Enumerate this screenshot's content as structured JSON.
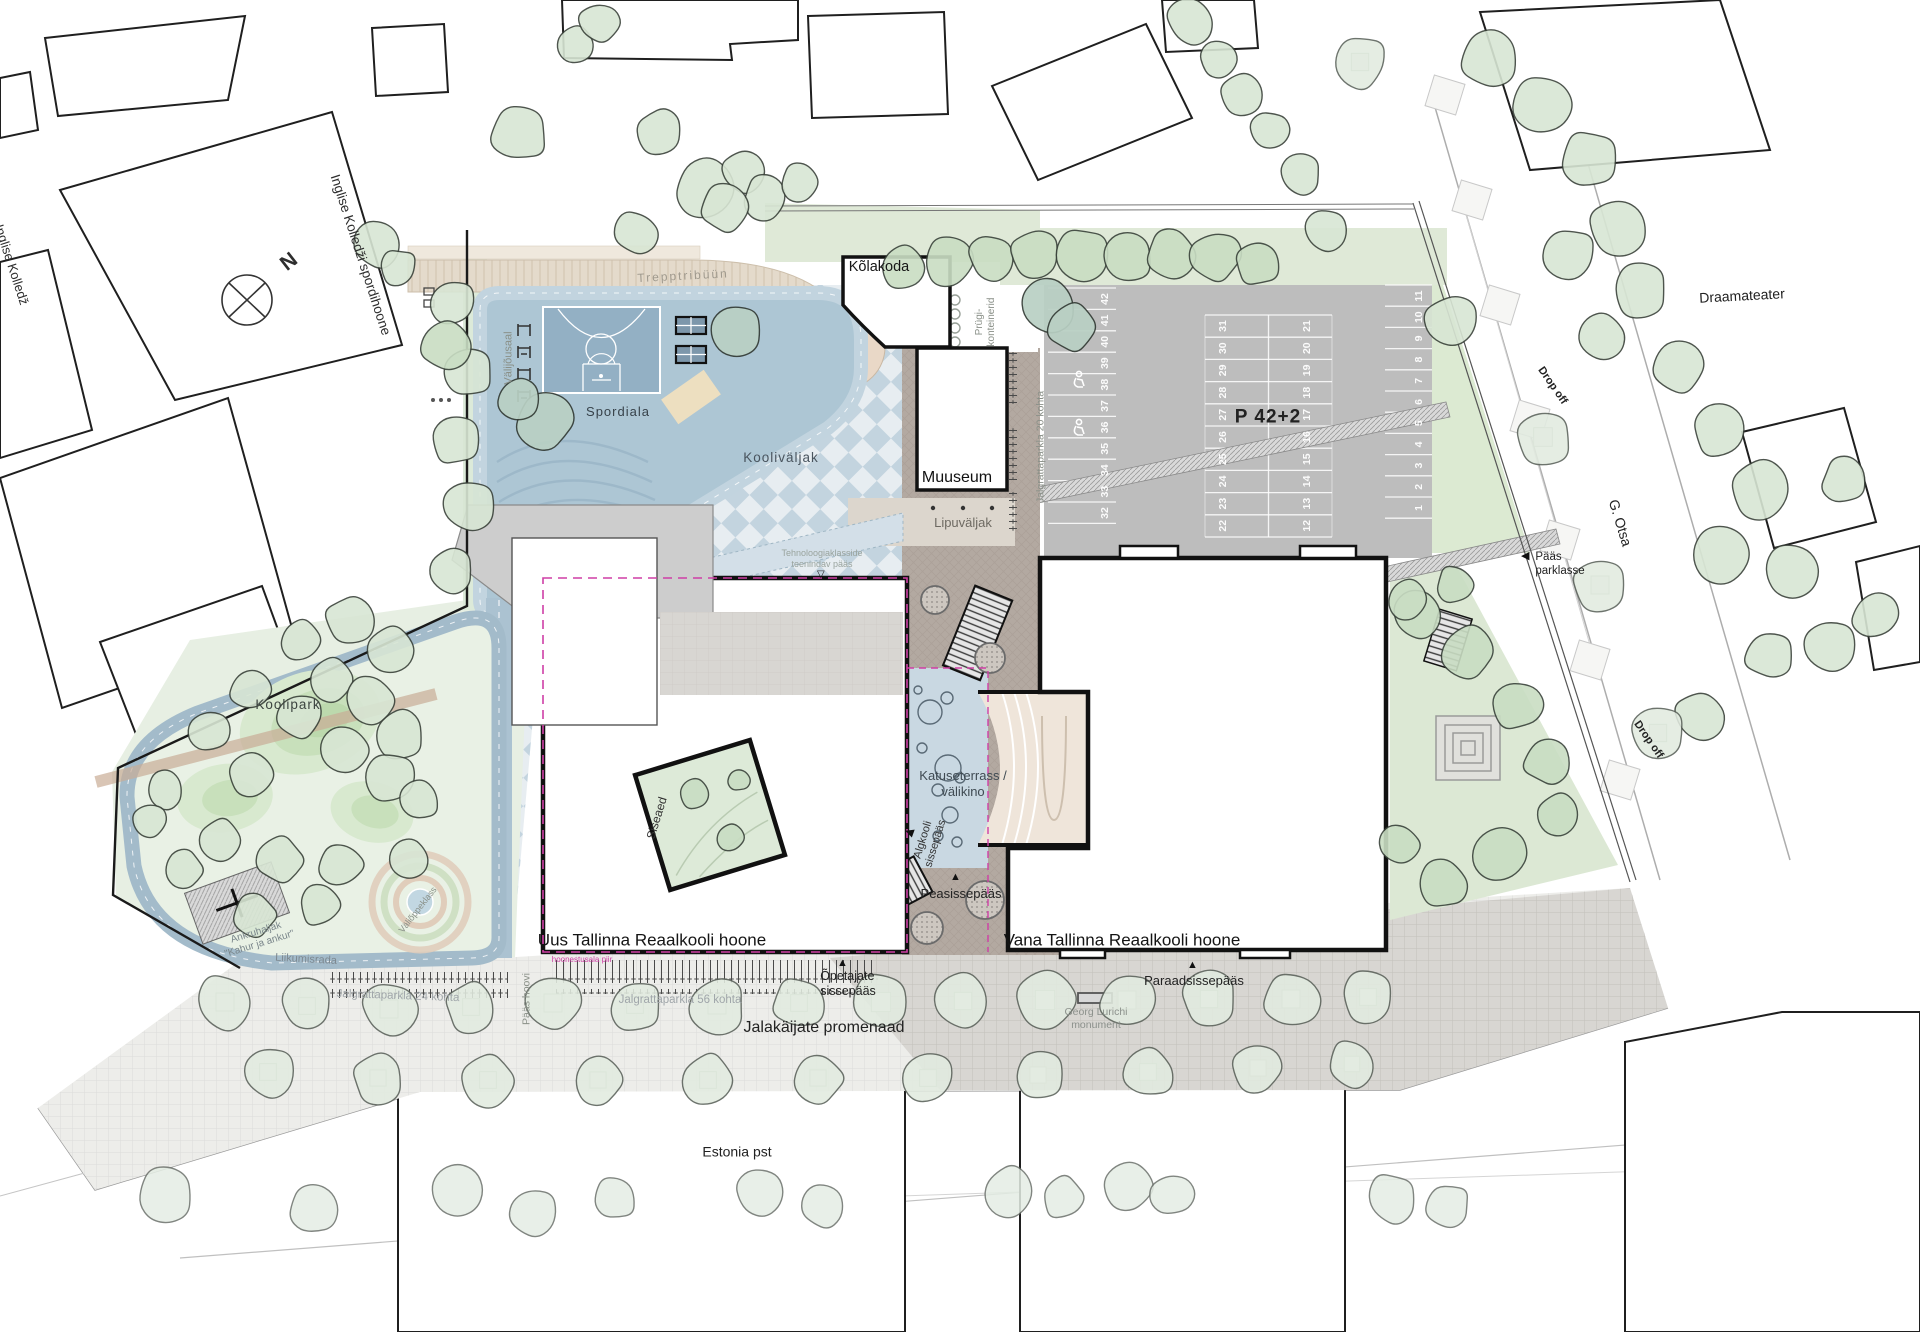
{
  "labels": {
    "n": "N",
    "inglise": "Inglise Kolledži spordihoone",
    "tallinna_inglise": "Tallinna Inglise Kolledž",
    "trepptribuun": "Trepptribüün",
    "valijousaal": "Välijõusaal",
    "spordiala": "Spordiala",
    "kolakoda": "Kõlakoda",
    "prugikonteinerid": "Prügi-\nkonteinerid",
    "jalgrattaparkla_20": "Jalgrattaparkla 20 kohta",
    "muuseum": "Muuseum",
    "lipuvaljak": "Lipuväljak",
    "koolivaljak": "Kooliväljak",
    "tehnoloogia": "Tehnoloogiaklasside\nteenindav pääs",
    "katuseterrass": "Katuseterrass /\nvälikino",
    "algkooli": "Algkooli\nsissepääs",
    "peasissepaas": "Peasissepääs",
    "siseaed": "Siseaed",
    "uus_hoone": "Uus Tallinna Reaalkooli hoone",
    "hoonestusala": "hoonestusala piir",
    "opetajate": "Õpetajate\nsissepääs",
    "vana_hoone": "Vana Tallinna Reaalkooli hoone",
    "paraadsissepaas": "Paraadsissepääs",
    "georg": "Georg Lurichi\nmonument",
    "jalakaijate": "Jalakäijate promenaad",
    "jalgrattaparkla_56": "Jalgrattaparkla 56 kohta",
    "jalgrattaparkla_24": "Jalgrattaparkla 24 kohta",
    "paas_hoovi": "Pääs hoovi",
    "liikumisrada": "Liikumisrada",
    "ankruhaljak": "Ankruhaljak\n\"Kahur ja ankur\"",
    "valioppeklass": "Väliõppeklass",
    "koolipark": "Koolipark",
    "estonia_pst": "Estonia pst",
    "draamateater": "Draamateater",
    "g_otsa": "G. Otsa",
    "drop_off_north": "Drop off",
    "drop_off_south": "Drop off",
    "paas_parklasse": "Pääs\nparklasse"
  },
  "icons": {
    "triangle_up": "▲",
    "triangle_left": "◀",
    "triangle_left_open": "◁",
    "triangle_down_open": "▽"
  },
  "parking": {
    "total_label": "P 42+2",
    "columns": [
      {
        "x": 1108,
        "y0": 299,
        "dy": 21.4,
        "stalls": [
          "42",
          "41",
          "40",
          "39",
          "38",
          "37",
          "36",
          "35",
          "34",
          "33",
          "32"
        ]
      },
      {
        "x": 1226,
        "y0": 326,
        "dy": 22.2,
        "stalls": [
          "31",
          "30",
          "29",
          "28",
          "27",
          "26",
          "25",
          "24",
          "23",
          "22"
        ]
      },
      {
        "x": 1310,
        "y0": 326,
        "dy": 22.2,
        "stalls": [
          "21",
          "20",
          "19",
          "18",
          "17",
          "16",
          "15",
          "14",
          "13",
          "12"
        ]
      },
      {
        "x": 1422,
        "y0": 296,
        "dy": 21.2,
        "stalls": [
          "11",
          "10",
          "9",
          "8",
          "7",
          "6",
          "5",
          "4",
          "3",
          "2",
          "1"
        ]
      }
    ]
  },
  "colors": {
    "checker_dark": "#c3d4df",
    "checker_light": "#e7edf1",
    "sports_blue": "#adc6d4",
    "court_blue": "#93b0c4",
    "beige_band": "#e4dacb",
    "park_green": "#e7efe3",
    "parking_gray": "#bdbdbd",
    "plaza_dark": "#b3a9a1",
    "terrace_blue": "#c9d8e2",
    "amphitheatre_beige": "#efe5da",
    "garden_green": "#dce8d4",
    "boundary_magenta": "#cf3fa6"
  }
}
